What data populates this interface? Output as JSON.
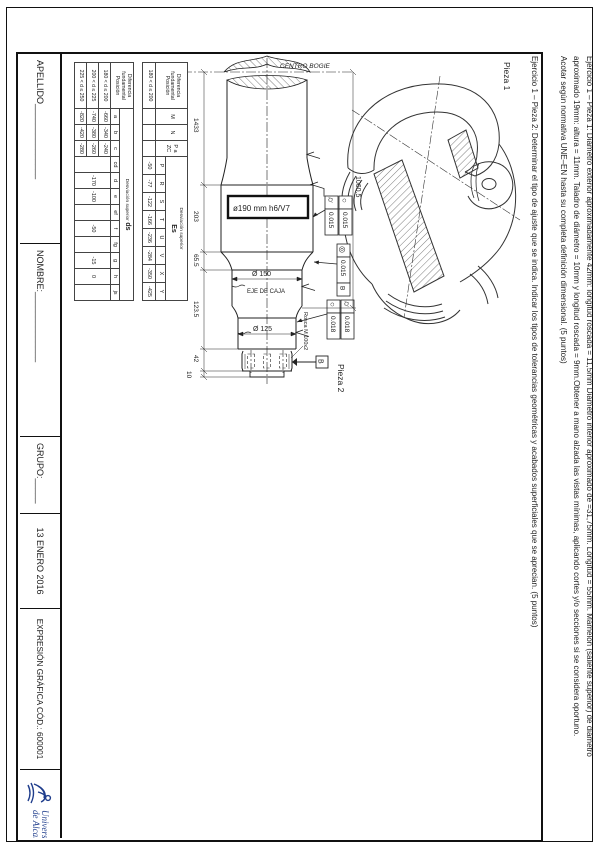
{
  "page": {
    "exercise_lines": [
      "Ejercicio 1 – Pieza 1: Diámetro exterior aproximadamente 42mm: longitud roscada = 11,5mm Diámetro interior aproximado de =31,75mm. Longitud = 55mm. Mamelón (saliente superior) de diámetro",
      "aproximado 19mm: altura = 11mm. Taladro de diámetro = 10mm y longitud roscada = 9mm.Obtener a mano alzada las vistas mínimas, aplicando cortes y/o secciones si se considera oportuno.",
      "Acotar según normativa UNE–EN hasta su completa definición dimensional. (5 puntos)",
      "Ejercicio 1 – Pieza 2: Determinar el tipo de ajuste que se indica. Indicar los tipos de tolerancias geométricas y acabados superficiales que se aprecian. (5 puntos)"
    ]
  },
  "footer": {
    "apellido": "APELLIDO_______________",
    "nombre": "NOMBRE:______________",
    "grupo": "GRUPO:_____",
    "date": "13 ENERO 2016",
    "course": "EXPRESIÓN GRÁFICA CÓD.: 600001",
    "logo_line1": "Universidad",
    "logo_line2": "de Alcalá",
    "logo_color": "#1f3d8c"
  },
  "drawing": {
    "pieza1": "Pieza 1",
    "pieza2": "Pieza 2",
    "centro_bogie": "CENTRO BOGIE",
    "eje_de_caja": "EJE DE CAJA",
    "fit_callout": "ø190 mm h6/V7",
    "d150": "Ø 150",
    "d125": "Ø 125",
    "rosca": "Rosca M 100x2",
    "dim_overall": "1060.5",
    "dim_chain": [
      "1433",
      "203",
      "65.5",
      "123.5",
      "42",
      "10"
    ],
    "tol": {
      "circularity_symbol": "○",
      "cylindricity_symbol": "⌭",
      "coaxiality_symbol": "◎",
      "v190_circ": "0.015",
      "v190_cyl": "0.015",
      "v_coax": "0.015",
      "coax_datum": "B",
      "v125_cyl": "0.018",
      "v125_circ": "0.018",
      "datum_b": "B"
    }
  },
  "tables": {
    "es": {
      "corner": "Diferencia fundamental",
      "posicion": "Posición",
      "row_label": "180 < d ≤ 200",
      "group_header": "Desviación superior",
      "group_title": "Es",
      "extra_cols": [
        "M",
        "N",
        "P a ZC"
      ],
      "cols": [
        "P",
        "R",
        "S",
        "T",
        "U",
        "V",
        "X",
        "Y"
      ],
      "values": [
        "-50",
        "-77",
        "-122",
        "-166",
        "-236",
        "-284",
        "-350",
        "-425"
      ]
    },
    "ds": {
      "corner": "Diferencia fundamental",
      "posicion": "Posición",
      "group_header": "Desviación superior",
      "group_title": "ds",
      "cols": [
        "a",
        "b",
        "c",
        "cd",
        "d",
        "e",
        "ef",
        "f",
        "fg",
        "g",
        "h",
        "js"
      ],
      "row_labels": [
        "180 < d ≤ 200",
        "200 < d ≤ 225",
        "225 < d ≤ 250"
      ],
      "abc_values": [
        [
          "-660",
          "-340",
          "-240"
        ],
        [
          "-740",
          "-380",
          "-260"
        ],
        [
          "-820",
          "-420",
          "-280"
        ]
      ],
      "shared": {
        "cd": "",
        "d": "-170",
        "e": "-100",
        "ef": "",
        "f": "-50",
        "fg": "",
        "g": "-15",
        "h": "0",
        "js": ""
      }
    }
  }
}
